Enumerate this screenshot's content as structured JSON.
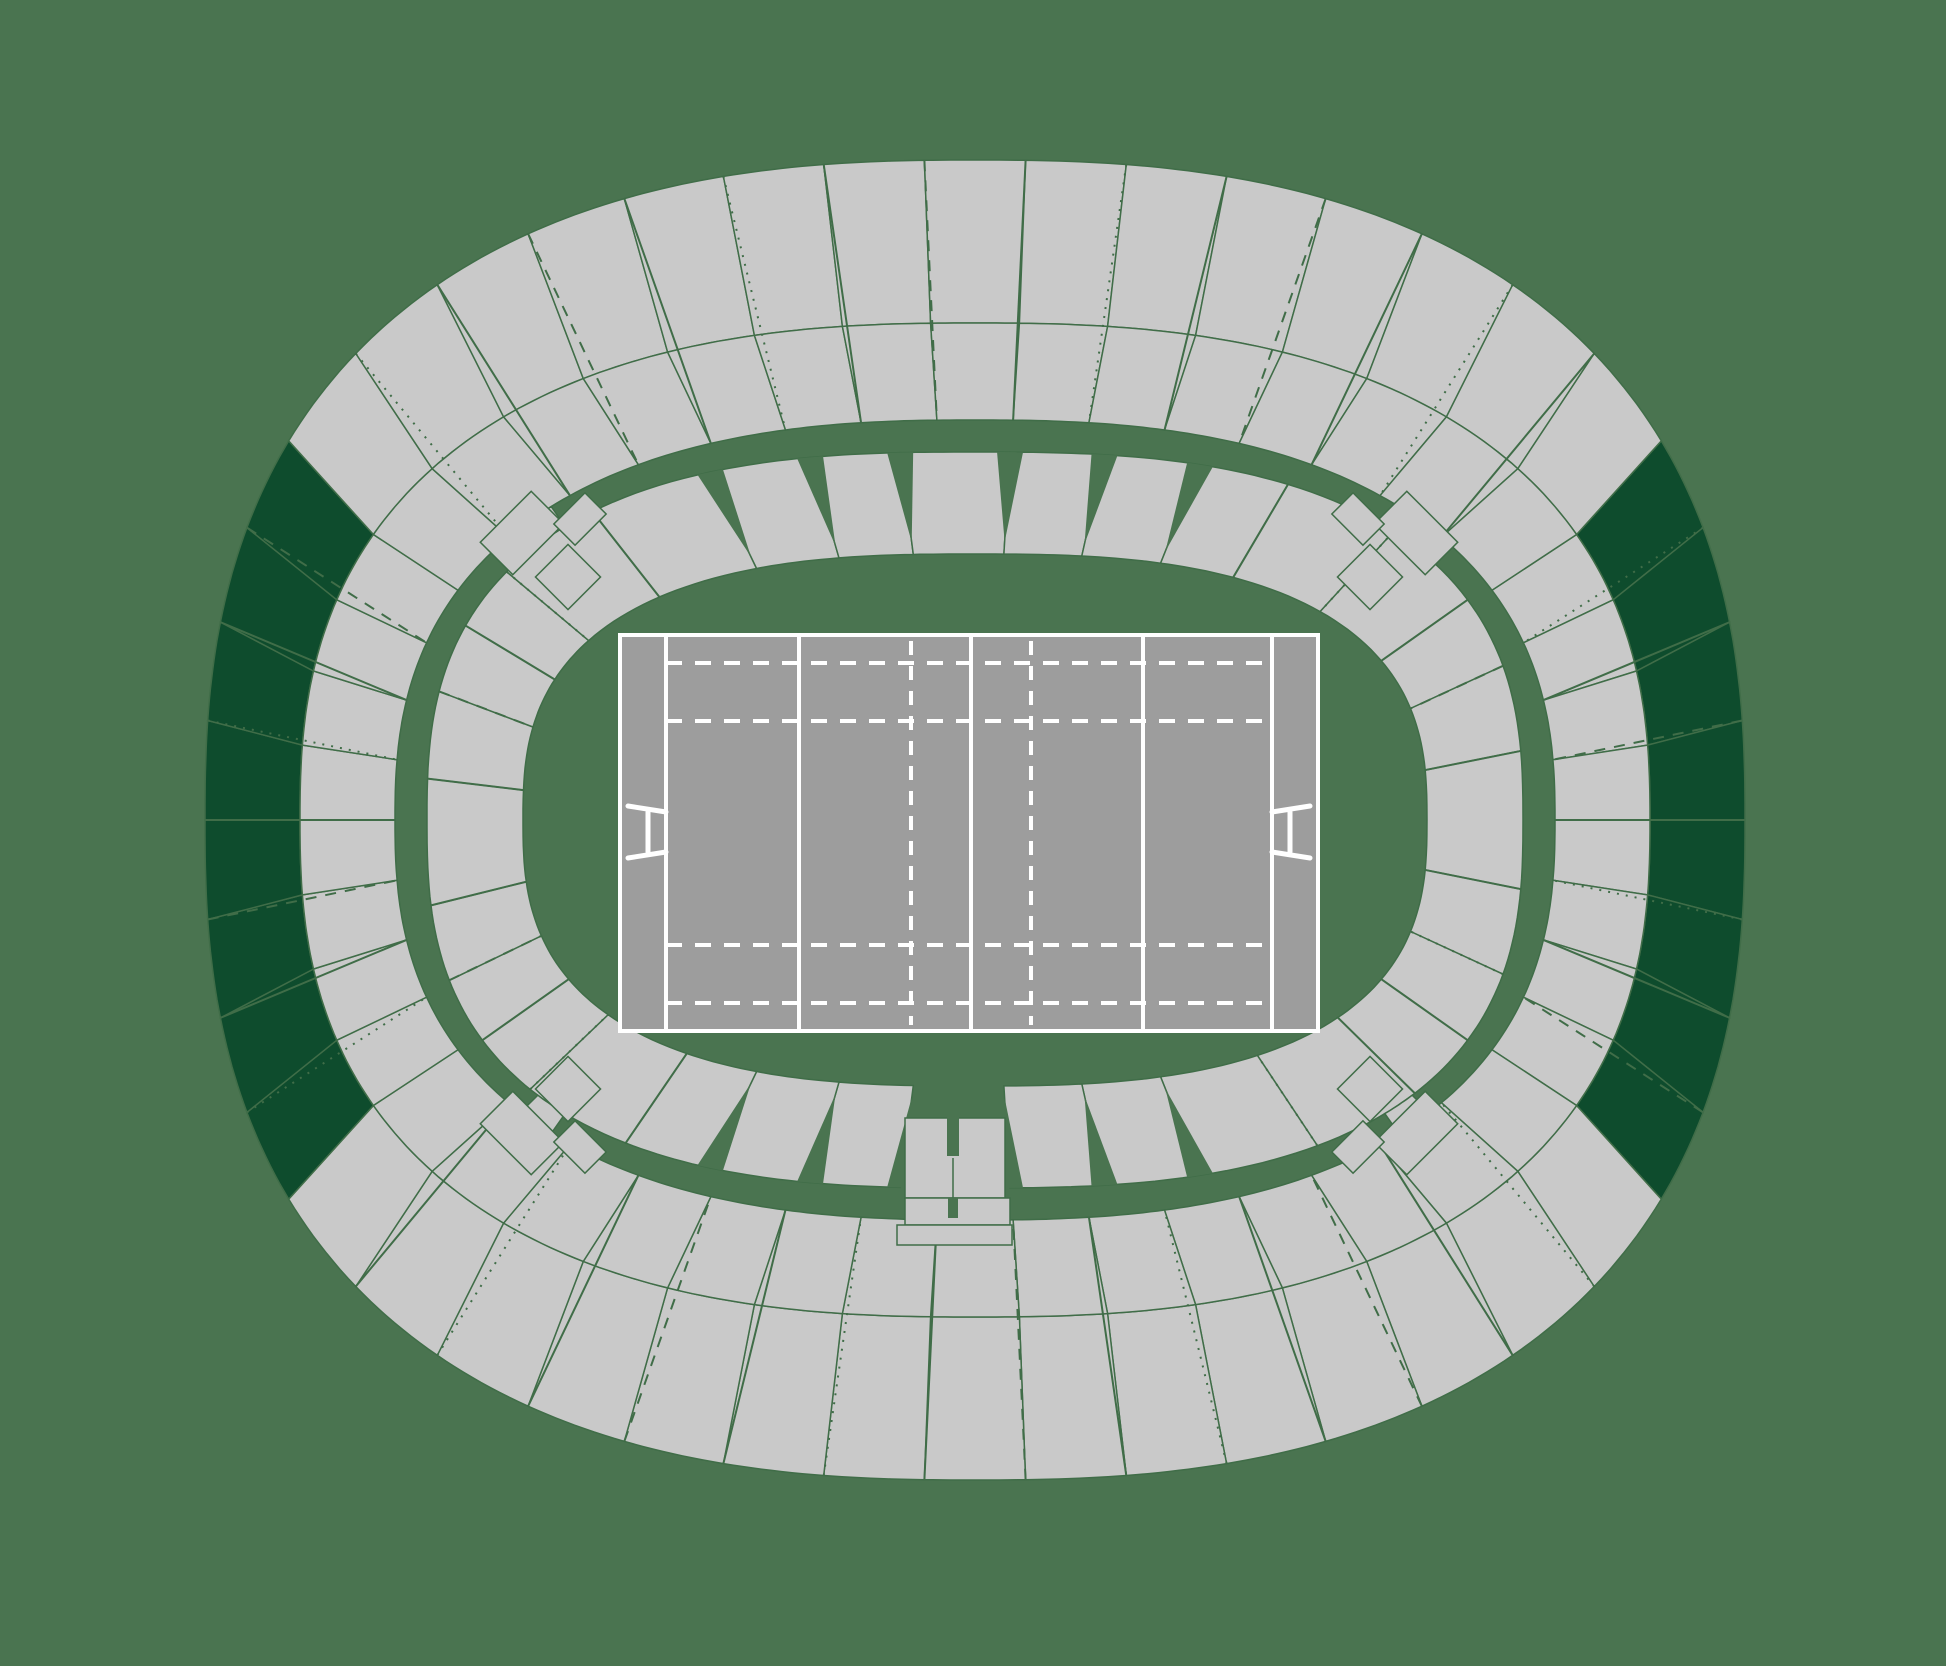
{
  "app": {
    "name": "stadium-seat-map",
    "description": "Oval stadium seating plan with rugby pitch, three concentric seating bands, highlighted sections on east and west outer ring"
  },
  "canvas": {
    "width": 1946,
    "height": 1666
  },
  "colors": {
    "background": "#4a7450",
    "section_fill": "#c9c9c9",
    "section_stroke": "#406d48",
    "highlight_fill": "#0e4c2d",
    "pitch_fill": "#9d9d9d",
    "pitch_line": "#ffffff"
  },
  "stadium": {
    "cx": 975,
    "cy": 820,
    "edges": {
      "e0": {
        "a": 770,
        "b": 660,
        "n": 2.5
      },
      "e1": {
        "a": 675,
        "b": 497,
        "n": 2.5
      },
      "e2": {
        "a": 580,
        "b": 400,
        "n": 2.5
      },
      "e3": {
        "a": 548,
        "b": 368,
        "n": 2.7
      },
      "e4": {
        "a": 452,
        "b": 266,
        "n": 2.7
      }
    },
    "tier_a": {
      "arcs": [
        {
          "from": -30,
          "to": 30,
          "sections": 8,
          "highlighted": true
        },
        {
          "from": 30,
          "to": 150,
          "sections": 15,
          "highlighted": false
        },
        {
          "from": 150,
          "to": 210,
          "sections": 8,
          "highlighted": true
        },
        {
          "from": 210,
          "to": 330,
          "sections": 15,
          "highlighted": false
        }
      ],
      "boundary_styles": [
        "solid",
        "dotted",
        "solid",
        "dashed"
      ]
    },
    "tier_b": {
      "boundaries": [
        {
          "t": 6,
          "style": "solid"
        },
        {
          "t": 18,
          "style": "dotted"
        },
        {
          "t": 30,
          "style": "solid"
        },
        {
          "t": 42,
          "style": "solid"
        },
        {
          "t": 58,
          "style": "dotted"
        },
        {
          "t": 72.5,
          "style": "wedge"
        },
        {
          "t": 81.8,
          "style": "wedge"
        },
        {
          "t": 88.6,
          "style": "wedge"
        },
        {
          "t": 93.9,
          "style": "wedge"
        },
        {
          "t": 101.4,
          "style": "wedge"
        },
        {
          "t": 112,
          "style": "wedge"
        },
        {
          "t": 123,
          "style": "solid"
        },
        {
          "t": 139,
          "style": "dotted"
        },
        {
          "t": 150,
          "style": "solid"
        },
        {
          "t": 161,
          "style": "dashed"
        },
        {
          "t": 172,
          "style": "solid"
        },
        {
          "t": 183,
          "style": "solid"
        },
        {
          "t": 194,
          "style": "dashed"
        },
        {
          "t": 205,
          "style": "solid"
        },
        {
          "t": 216,
          "style": "dotted"
        },
        {
          "t": 232,
          "style": "solid"
        },
        {
          "t": 248,
          "style": "wedge"
        },
        {
          "t": 258.6,
          "style": "wedge"
        },
        {
          "t": 266.1,
          "style": "wedge"
        },
        {
          "t": 271.4,
          "style": "wedge"
        },
        {
          "t": 278.2,
          "style": "wedge"
        },
        {
          "t": 287.5,
          "style": "wedge"
        },
        {
          "t": 298,
          "style": "solid"
        },
        {
          "t": 314,
          "style": "dotted"
        },
        {
          "t": 330,
          "style": "solid"
        },
        {
          "t": 342,
          "style": "dashed"
        },
        {
          "t": 354,
          "style": "solid"
        }
      ],
      "tunnel_gap_between": [
        88.6,
        93.9
      ],
      "wedge_half_width": 13,
      "wedge_depth": 0.88
    },
    "bridges": {
      "angles": [
        45,
        135,
        225,
        315
      ],
      "half_width_deg": 2.5
    },
    "corner_clusters": {
      "corners": [
        {
          "x": 620,
          "y": 635,
          "sx": -1,
          "sy": -1
        },
        {
          "x": 1318,
          "y": 635,
          "sx": 1,
          "sy": -1
        },
        {
          "x": 620,
          "y": 1031,
          "sx": -1,
          "sy": 1
        },
        {
          "x": 1318,
          "y": 1031,
          "sx": 1,
          "sy": 1
        }
      ],
      "pieces": [
        {
          "u": 52,
          "v": 58,
          "w": 46,
          "h": 46
        },
        {
          "u": 98,
          "v": 102,
          "w": 46,
          "h": 72
        },
        {
          "u": 40,
          "v": 116,
          "w": 30,
          "h": 44
        }
      ]
    },
    "tunnel": {
      "main": {
        "x": 905,
        "y": 1118,
        "w": 100,
        "h": 80
      },
      "notch1": {
        "x": 947,
        "y": 1114,
        "w": 12,
        "h": 42
      },
      "ext": {
        "x": 905,
        "y": 1198,
        "w": 105,
        "h": 27
      },
      "notch2": {
        "x": 948,
        "y": 1198,
        "w": 10,
        "h": 20
      },
      "base": {
        "x": 897,
        "y": 1225,
        "w": 115,
        "h": 20
      },
      "divider_x": 953
    }
  },
  "pitch": {
    "x": 620,
    "y": 635,
    "w": 698,
    "h": 396,
    "solid_vlines": [
      666,
      799,
      971,
      1143,
      1272
    ],
    "dashed_vlines": [
      911,
      1031
    ],
    "dashed_hlines": [
      663,
      721,
      945,
      1003
    ],
    "hline_x1": 666,
    "hline_x2": 1272,
    "goal_posts": [
      {
        "bar_x": 648,
        "attach_x": 666,
        "out_x": 628
      },
      {
        "bar_x": 1290,
        "attach_x": 1272,
        "out_x": 1310
      }
    ],
    "post_y_top": 812,
    "post_y_bot": 852,
    "post_flare": 6
  }
}
